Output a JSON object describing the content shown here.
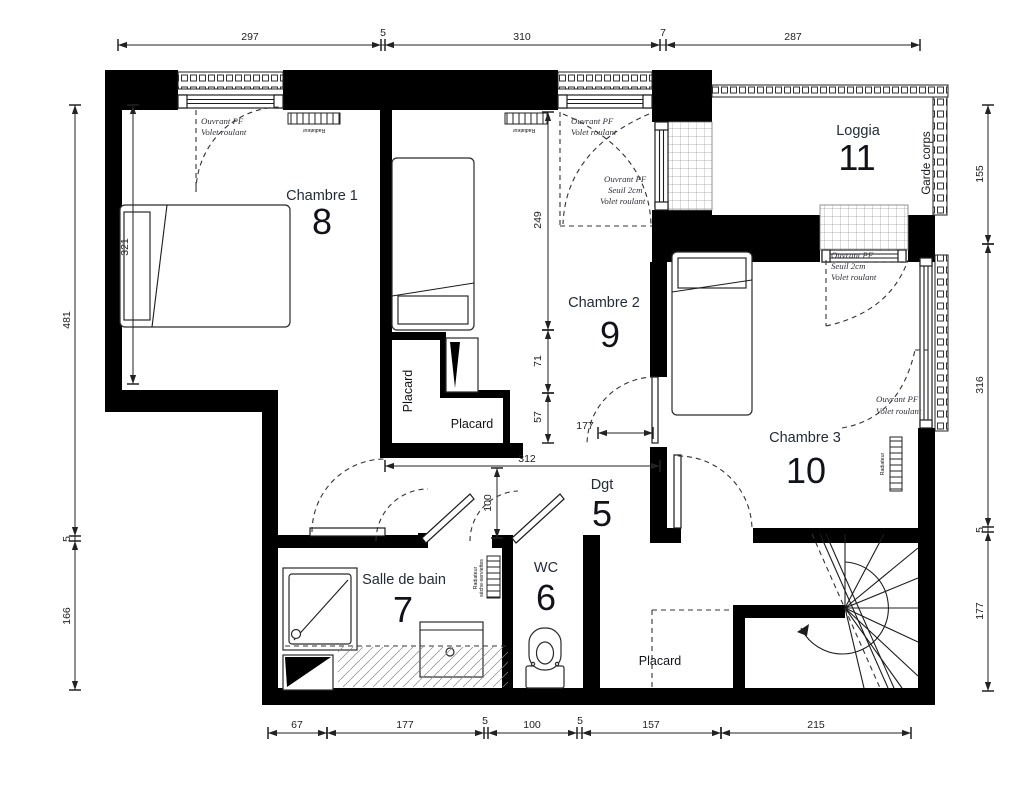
{
  "rooms": {
    "chambre1": {
      "name": "Chambre 1",
      "num": "8"
    },
    "chambre2": {
      "name": "Chambre 2",
      "num": "9"
    },
    "chambre3": {
      "name": "Chambre 3",
      "num": "10"
    },
    "loggia": {
      "name": "Loggia",
      "num": "11"
    },
    "dgt": {
      "name": "Dgt",
      "num": "5"
    },
    "wc": {
      "name": "WC",
      "num": "6"
    },
    "sdb": {
      "name": "Salle de bain",
      "num": "7"
    }
  },
  "closets": {
    "placard1": "Placard",
    "placard2": "Placard",
    "placard3": "Placard"
  },
  "equipment": {
    "garde_corps": "Garde corps",
    "radiateur": "Radiateur",
    "seche_serviettes": "sèche-serviettes"
  },
  "annotations": {
    "c1_win": {
      "l1": "Ouvrant PF",
      "l2": "Volet roulant"
    },
    "c2_win": {
      "l1": "Ouvrant PF",
      "l2": "Volet roulant"
    },
    "loggia_door": {
      "l1": "Ouvrant PF",
      "l2": "Seuil 2cm",
      "l3": "Volet roulant"
    },
    "c3_top_win": {
      "l1": "Ouvrant PF",
      "l2": "Seuil 2cm",
      "l3": "Volet roulant"
    },
    "c3_right_win": {
      "l1": "Ouvrant PF",
      "l2": "Volet roulant"
    }
  },
  "dims": {
    "top": [
      "297",
      "5",
      "310",
      "7",
      "287"
    ],
    "bottom": [
      "67",
      "177",
      "5",
      "100",
      "5",
      "157",
      "215"
    ],
    "left": [
      "481",
      "5",
      "166"
    ],
    "right": [
      "155",
      "316",
      "5",
      "177"
    ],
    "bed1": "321",
    "c2_a": "249",
    "c2_b": "71",
    "c2_c": "57",
    "door": "177",
    "hall_w": "312",
    "hall_h": "100"
  }
}
